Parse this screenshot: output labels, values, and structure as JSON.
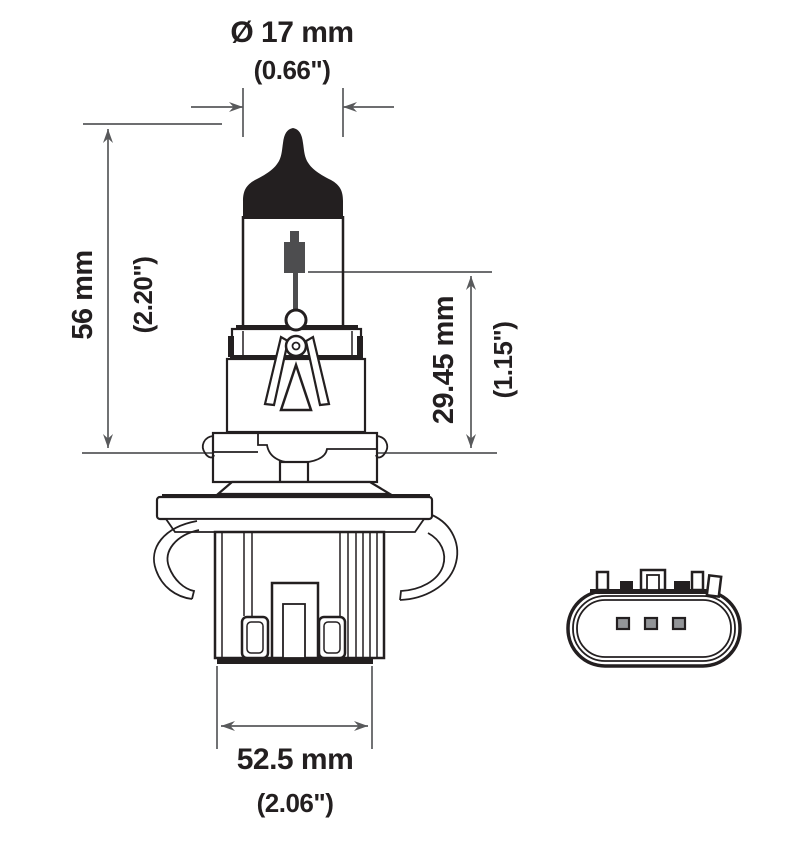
{
  "drawing": {
    "title": "bulb-technical-drawing",
    "dimensions": {
      "diameter": {
        "metric": "Ø 17 mm",
        "imperial": "(0.66\")"
      },
      "overall_length": {
        "metric": "56 mm",
        "imperial": "(2.20\")"
      },
      "filament_to_flange": {
        "metric": "29.45 mm",
        "imperial": "(1.15\")"
      },
      "base_width": {
        "metric": "52.5 mm",
        "imperial": "(2.06\")"
      }
    },
    "colors": {
      "outline": "#231f20",
      "dimension_line": "#58595b",
      "metal_gray": "#4d4d4f",
      "pin_gray": "#939598",
      "background": "#ffffff"
    }
  }
}
